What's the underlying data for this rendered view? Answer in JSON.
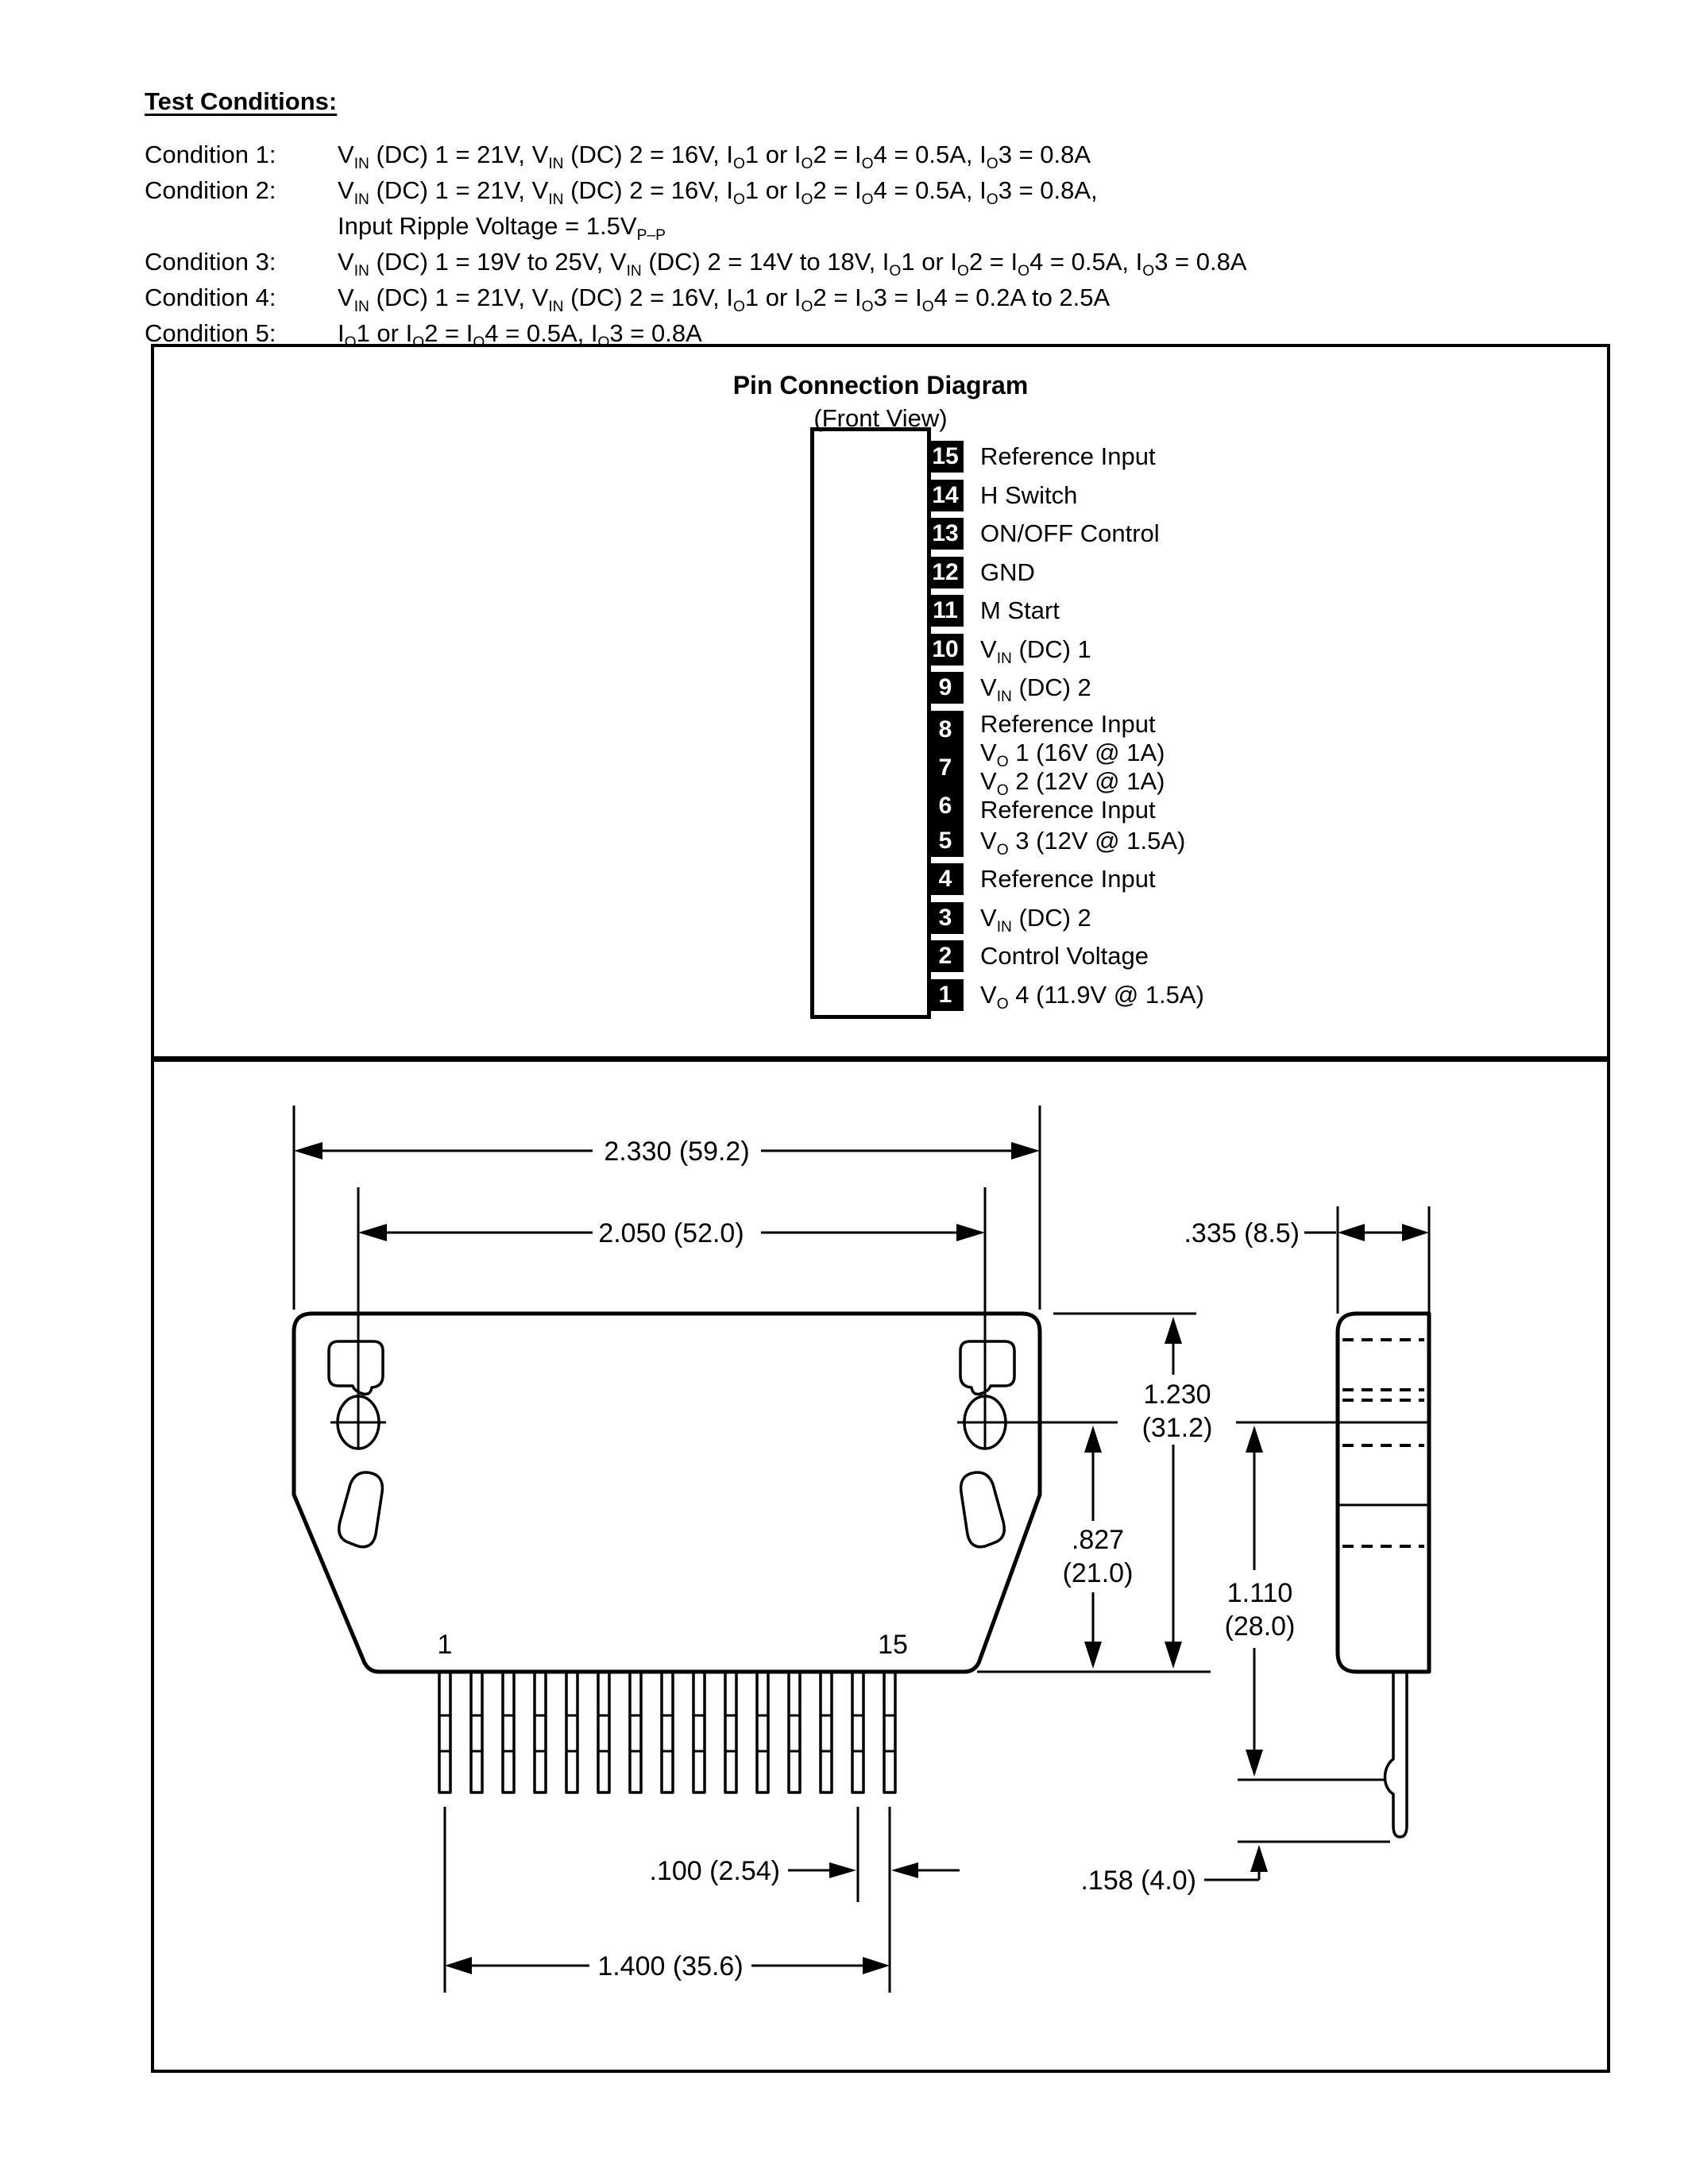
{
  "page": {
    "paper_color": "#ffffff",
    "ink_color": "#000000"
  },
  "test_conditions": {
    "title": "Test Conditions:",
    "items": [
      {
        "label": "Condition 1:",
        "lines": [
          "V_{IN} (DC) 1 = 21V, V_{IN} (DC) 2 = 16V, I_{O}1 or I_{O}2 = I_{O}4 = 0.5A, I_{O}3 = 0.8A"
        ]
      },
      {
        "label": "Condition 2:",
        "lines": [
          "V_{IN} (DC) 1 = 21V, V_{IN} (DC) 2 = 16V, I_{O}1 or I_{O}2 = I_{O}4 = 0.5A, I_{O}3 = 0.8A,",
          "Input Ripple Voltage = 1.5V_{P–P}"
        ]
      },
      {
        "label": "Condition 3:",
        "lines": [
          "V_{IN} (DC) 1 = 19V to 25V, V_{IN} (DC) 2 = 14V to 18V, I_{O}1 or I_{O}2 = I_{O}4 = 0.5A, I_{O}3 = 0.8A"
        ]
      },
      {
        "label": "Condition 4:",
        "lines": [
          "V_{IN} (DC) 1 = 21V, V_{IN} (DC) 2 = 16V, I_{O}1 or I_{O}2 = I_{O}3 = I_{O}4 = 0.2A to 2.5A"
        ]
      },
      {
        "label": "Condition 5:",
        "lines": [
          "I_{O}1 or I_{O}2 = I_{O}4 = 0.5A, I_{O}3 = 0.8A"
        ]
      }
    ]
  },
  "pin_diagram": {
    "title": "Pin Connection Diagram",
    "subtitle": "(Front View)",
    "pins": [
      {
        "number": "15",
        "label": "Reference Input"
      },
      {
        "number": "14",
        "label": "H Switch"
      },
      {
        "number": "13",
        "label": "ON/OFF Control"
      },
      {
        "number": "12",
        "label": "GND"
      },
      {
        "number": "11",
        "label": "M Start"
      },
      {
        "number": "10",
        "label": "V_{IN} (DC) 1"
      },
      {
        "number": "9",
        "label": "V_{IN} (DC) 2"
      },
      {
        "number": "8",
        "label": "Reference Input"
      },
      {
        "number": "7",
        "label": "V_{O} 1 (16V @ 1A)",
        "label2": "V_{O} 2 (12V @ 1A)"
      },
      {
        "number": "6",
        "label": "Reference Input"
      },
      {
        "number": "5",
        "label": "V_{O} 3 (12V @ 1.5A)"
      },
      {
        "number": "4",
        "label": "Reference Input"
      },
      {
        "number": "3",
        "label": "V_{IN} (DC) 2"
      },
      {
        "number": "2",
        "label": "Control Voltage"
      },
      {
        "number": "1",
        "label": "V_{O} 4 (11.9V @ 1.5A)"
      }
    ]
  },
  "dimension_drawing": {
    "front_view_pin_count": 15,
    "labels": {
      "overall_width": "2.330 (59.2)",
      "mount_hole_span": "2.050 (52.0)",
      "body_depth": ".335 (8.5)",
      "overall_height_in": "1.230",
      "overall_height_mm": "(31.2)",
      "hole_to_base_in": ".827",
      "hole_to_base_mm": "(21.0)",
      "hole_to_pin_end_in": "1.110",
      "hole_to_pin_end_mm": "(28.0)",
      "pin_pitch": ".100 (2.54)",
      "pin_row_span": "1.400 (35.6)",
      "pin_tip_length": ".158 (4.0)",
      "first_pin": "1",
      "last_pin": "15"
    }
  }
}
